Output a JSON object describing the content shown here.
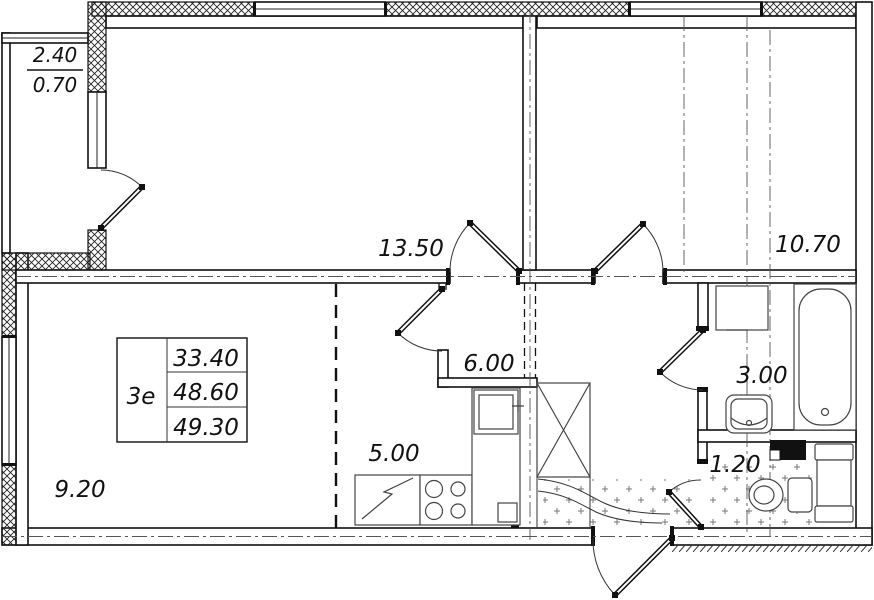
{
  "plan": {
    "title": "apartment-floor-plan",
    "stamp": {
      "flat_type": "3е",
      "living_area": "33.40",
      "area_without_balcony": "48.60",
      "total_area": "49.30"
    },
    "balcony": {
      "full_area": "2.40",
      "reduced_area": "0.70"
    },
    "rooms": {
      "room1": "13.50",
      "room2": "10.70",
      "living": "9.20",
      "kitchen": "5.00",
      "hall": "6.00",
      "bath": "3.00",
      "wc": "1.20"
    },
    "fixtures": [
      "bathtub",
      "washbasin",
      "washing-machine",
      "toilet",
      "cabinet-column",
      "vent-shaft",
      "kitchen-sink",
      "stove",
      "fridge",
      "built-in-wardrobe",
      "tile-floor-dots"
    ],
    "colors": {
      "line": "#111111",
      "fixture_line": "#444444",
      "background": "#ffffff"
    }
  }
}
